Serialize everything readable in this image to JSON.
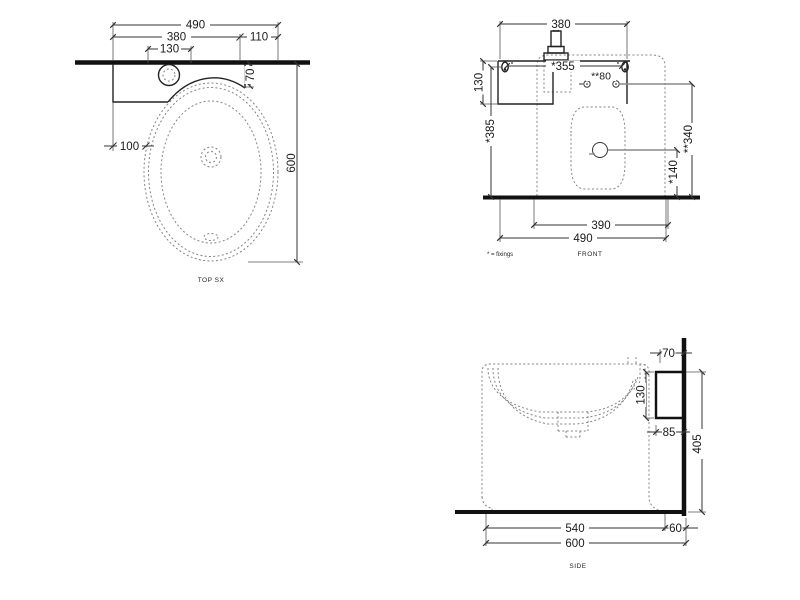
{
  "colors": {
    "background": "#ffffff",
    "solid_line": "#222222",
    "heavy_line": "#111111",
    "hidden_line": "#848484",
    "dimension_text": "#1a1a1a"
  },
  "views": {
    "top": {
      "label": "TOP SX",
      "overall_width": "490",
      "shelf_width": "380",
      "tap_center_width": "130",
      "side_offset": "110",
      "rim_to_wall": "70",
      "edge_to_basin": "100",
      "overall_depth": "600"
    },
    "front": {
      "label": "FRONT",
      "fixings_note": "* = fixings",
      "shelf_width": "380",
      "fixing_span": "*355",
      "basin_fixing_span": "**80",
      "shelf_drop": "130",
      "shelf_fixing_height": "*385",
      "drain_height": "*140",
      "basin_fixing_height": "**340",
      "base_width": "390",
      "overall_width": "490"
    },
    "side": {
      "label": "SIDE",
      "rim_to_wall": "70",
      "bracket_height": "130",
      "gap_below_bracket": "85",
      "bracket_top_height": "405",
      "basin_depth": "540",
      "wall_gap": "60",
      "overall_depth": "600"
    }
  }
}
